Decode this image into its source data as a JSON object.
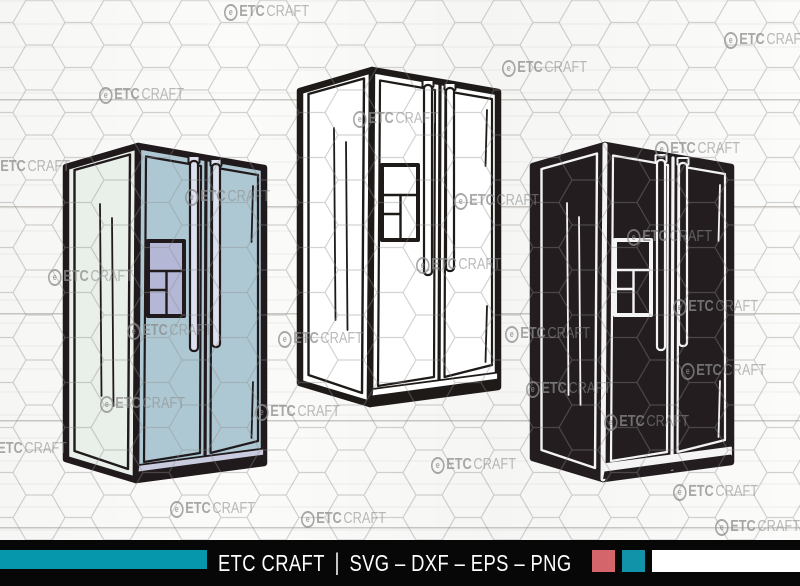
{
  "canvas": {
    "width": 800,
    "height": 586
  },
  "background": {
    "base_color": "#fbfbfa",
    "plank_line_color": "#7d7468",
    "hex_line_color": "#8c8c8c"
  },
  "watermark": {
    "logo_glyph": "e",
    "bold_text": "ETC",
    "light_text": "CRAFT",
    "color": "#8c8c8c",
    "positions": [
      [
        224,
        3
      ],
      [
        724,
        31
      ],
      [
        502,
        59
      ],
      [
        99,
        86
      ],
      [
        353,
        110
      ],
      [
        655,
        140
      ],
      [
        -15,
        158
      ],
      [
        185,
        188
      ],
      [
        454,
        192
      ],
      [
        627,
        228
      ],
      [
        48,
        268
      ],
      [
        416,
        256
      ],
      [
        673,
        298
      ],
      [
        127,
        322
      ],
      [
        278,
        330
      ],
      [
        505,
        325
      ],
      [
        681,
        362
      ],
      [
        100,
        395
      ],
      [
        255,
        403
      ],
      [
        526,
        380
      ],
      [
        604,
        413
      ],
      [
        -18,
        440
      ],
      [
        431,
        456
      ],
      [
        673,
        483
      ],
      [
        170,
        500
      ],
      [
        301,
        510
      ],
      [
        715,
        518
      ]
    ]
  },
  "fridges": [
    {
      "label": "side-by-side refrigerator, light blue colored style",
      "x": 66,
      "y": 144,
      "colors": {
        "ol": "#211a1d",
        "line": "#211a1d",
        "front": "#aec8d3",
        "side": "#e9efe9",
        "disp": "#b5b7d6",
        "handle": "#dde0ee",
        "accent": "#c9ccdf"
      }
    },
    {
      "label": "side-by-side refrigerator, black outline style",
      "x": 300,
      "y": 68,
      "colors": {
        "ol": "#1e1a18",
        "line": "#1e1a18",
        "front": "#ffffff",
        "side": "#ffffff",
        "disp": "#ffffff",
        "handle": "#ffffff",
        "accent": "#ffffff"
      }
    },
    {
      "label": "side-by-side refrigerator, black silhouette style",
      "x": 533,
      "y": 143,
      "colors": {
        "ol": "#231d20",
        "line": "#f4f4f4",
        "front": "#231d20",
        "side": "#231d20",
        "disp": "#231d20",
        "handle": "#231d20",
        "accent": "#f4f4f4"
      }
    }
  ],
  "footer": {
    "brand": "ETC CRAFT",
    "divider": "|",
    "formats": "SVG – DXF – EPS – PNG",
    "bg_color": "#070707",
    "bar_color": "#0797ac",
    "text_color": "#ffffff",
    "swatches": [
      "#d4666b",
      "#1193a9",
      "#ffffff"
    ]
  }
}
